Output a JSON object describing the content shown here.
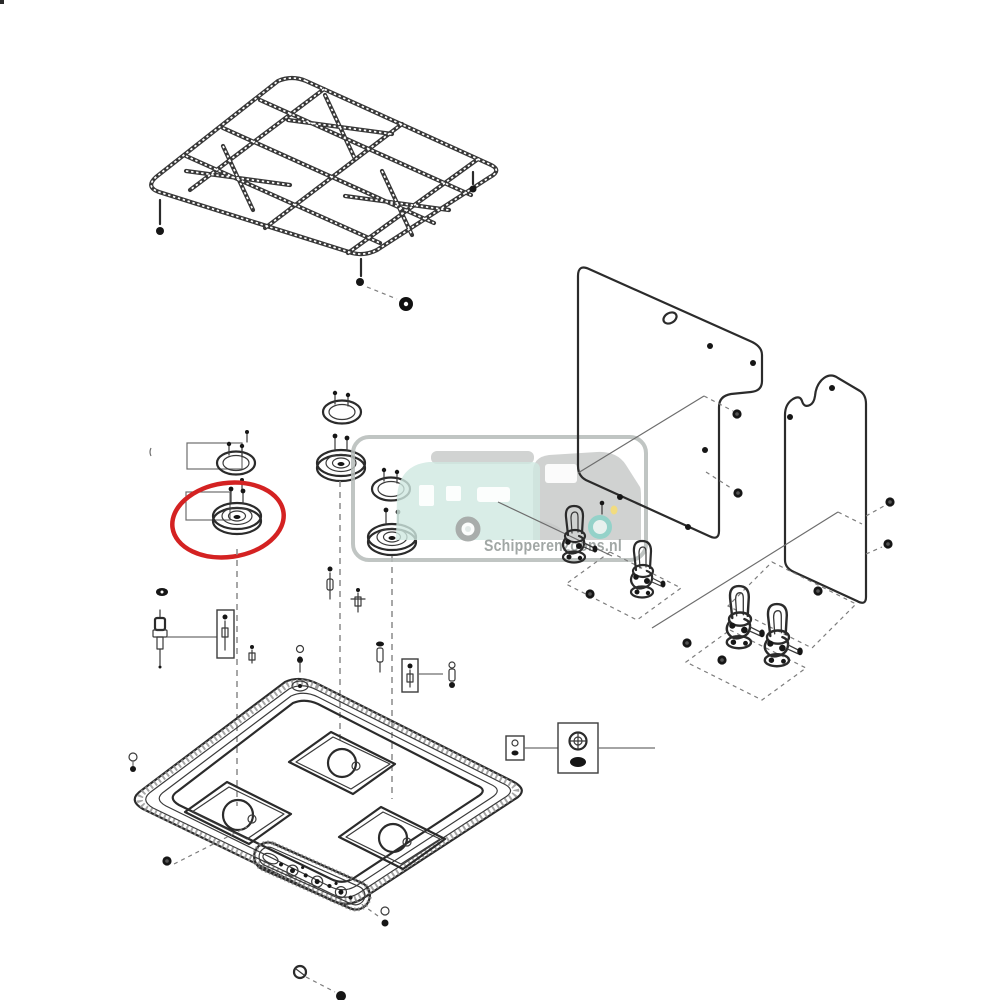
{
  "page": {
    "background": "#ffffff",
    "kind": "exploded-parts-diagram",
    "subject": "three-burner-gas-hob"
  },
  "highlight": {
    "color": "#d42222",
    "marks_part": "burner-cap-left"
  },
  "watermark": {
    "text": "Schipperenzoons.nl",
    "text_color": "#9aa09e",
    "frame_color": "#b5bbb9",
    "caravan_color": "#cfe8e1",
    "grey": "#c6c8c7",
    "accent_teal": "#8fd2c9",
    "wheel_grey": "#a3a7a5",
    "headlight_yellow": "#f3dc7a"
  },
  "diagram": {
    "line_color": "#2b2b2b",
    "dash_color": "#8a8a8a",
    "parts": [
      "pan-support-grate",
      "grate-foot",
      "grate-foot-grommet",
      "burner-trim-ring-left",
      "burner-cap-left",
      "mounting-bracket-upper",
      "mounting-bracket-lower",
      "burner-trim-ring-middle",
      "burner-cap-middle",
      "burner-trim-ring-right",
      "burner-cap-right",
      "igniter-electrode",
      "injector-jet",
      "fixing-screw",
      "callout-box-igniter",
      "callout-box-jet",
      "callout-box-small-parts",
      "callout-box-burner-base",
      "main-hob-tray",
      "burner-recess-left",
      "burner-recess-middle",
      "burner-recess-right",
      "control-panel-cutout",
      "side-panel-large",
      "side-panel-small",
      "lid-hinge-bracket-1",
      "lid-hinge-bracket-2",
      "lid-hinge-bracket-3",
      "lid-hinge-bracket-4",
      "mounting-outline-dashed"
    ]
  }
}
